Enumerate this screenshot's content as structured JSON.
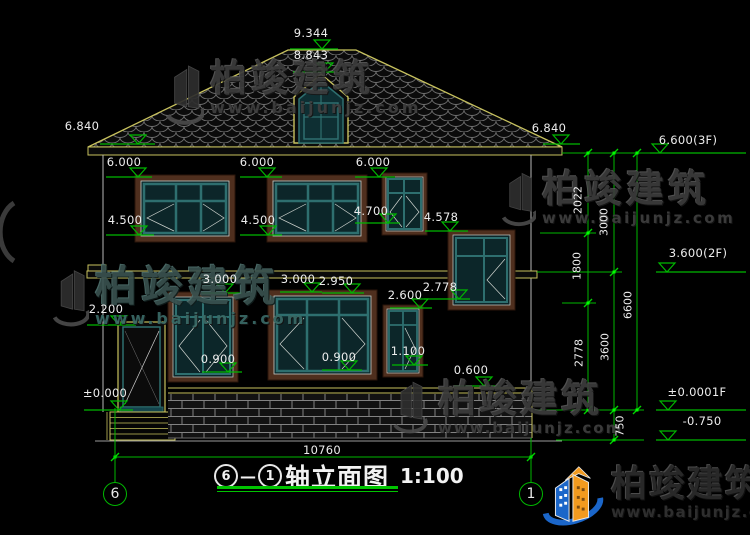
{
  "title_block": {
    "axis_start": "6",
    "dash": "—",
    "axis_end": "1",
    "title": "轴立面图",
    "scale": "1:100"
  },
  "axis_bubbles": {
    "left": "6",
    "right": "1"
  },
  "levels": {
    "v9344": "9.344",
    "v8843": "8.843",
    "v6840l": "6.840",
    "v6840r": "6.840",
    "v6600": "6.600(3F)",
    "v3600": "3.600(2F)",
    "v0000r": "±0.0001F",
    "vn750": "-0.750",
    "v6000a": "6.000",
    "v6000b": "6.000",
    "v6000c": "6.000",
    "v4500a": "4.500",
    "v4500b": "4.500",
    "v4700": "4.700",
    "v4578": "4.578",
    "v3000a": "3.000",
    "v3000b": "3.000",
    "v2950": "2.950",
    "v2600": "2.600",
    "v2778": "2.778",
    "v2200": "2.200",
    "v0900a": "0.900",
    "v0900b": "0.900",
    "v1100": "1.100",
    "v0600": "0.600",
    "v0000l": "±0.000"
  },
  "dims": {
    "d2022": "2022",
    "d1800": "1800",
    "d2778": "2778",
    "d3000": "3000",
    "d3600": "3600",
    "d750": "750",
    "d6600": "6600",
    "d10760": "10760"
  },
  "watermark": {
    "brand": "柏竣建筑",
    "url": "www.baijunjz.com"
  },
  "colors": {
    "cad_green": "#00b800",
    "cad_yellow": "#c8c25e",
    "window_teal": "#2e6f6f",
    "frame_brown": "#4f2f1e",
    "brand_blue": "#1b66c9",
    "brand_orange": "#f29a1f"
  }
}
